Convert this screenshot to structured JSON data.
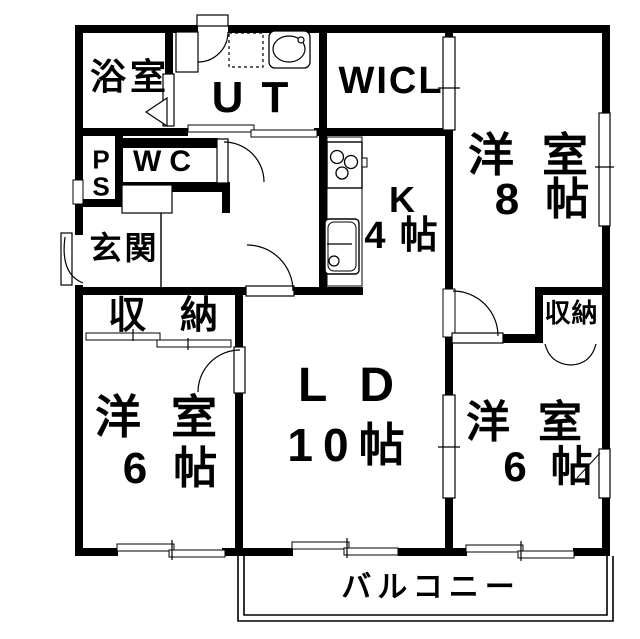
{
  "plan_title": "apartment-floor-plan",
  "colors": {
    "wall": "#000000",
    "background": "#ffffff",
    "line": "#000000"
  },
  "rooms": {
    "bathroom": {
      "label": "浴室"
    },
    "utility": {
      "label": "UT"
    },
    "wicl": {
      "label": "WICL"
    },
    "pipe_space": {
      "label": "PS"
    },
    "wc": {
      "label": "WC"
    },
    "entrance": {
      "label": "玄関"
    },
    "kitchen": {
      "label": "K",
      "size": "4帖"
    },
    "bedroom8": {
      "label": "洋室",
      "size": "8帖"
    },
    "living_dining": {
      "label": "LD",
      "size": "10帖"
    },
    "bedroom6_left": {
      "label": "洋室",
      "size": "6帖"
    },
    "bedroom6_right": {
      "label": "洋室",
      "size": "6帖"
    },
    "storage_left": {
      "label": "収納"
    },
    "storage_right": {
      "label": "収納"
    },
    "balcony": {
      "label": "バルコニー"
    }
  },
  "fixtures": {
    "washing_machine_pan": "dashed-square",
    "washbasin": "oval-basin",
    "gas_stove": "three-burner-cooktop",
    "kitchen_sink": "rect-basin-with-faucet",
    "shoe_cabinet": "rect-cabinet",
    "doors": [
      "hinged-door",
      "sliding-door",
      "folding-door",
      "bifold-closet-door"
    ],
    "windows": [
      "sliding-window"
    ]
  }
}
